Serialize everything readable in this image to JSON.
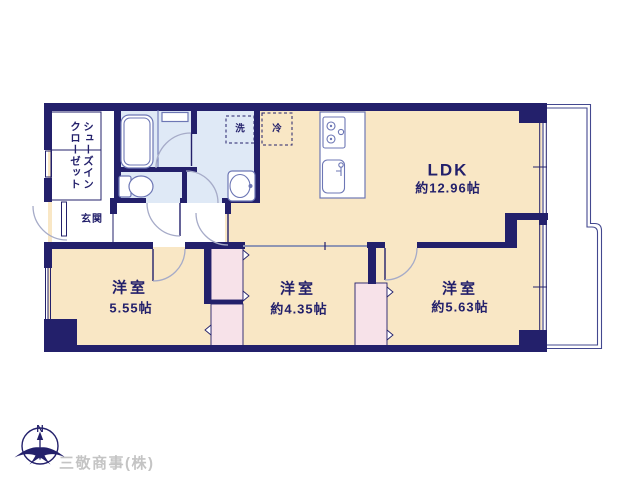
{
  "floor_plan": {
    "rooms": {
      "ldk": {
        "label": "LDK",
        "size": "約12.96帖"
      },
      "bedroom_left": {
        "label": "洋室",
        "size": "5.55帖"
      },
      "bedroom_middle": {
        "label": "洋室",
        "size": "約4.35帖"
      },
      "bedroom_right": {
        "label": "洋室",
        "size": "約5.63帖"
      },
      "entrance": {
        "label": "玄関"
      },
      "shoe_closet": {
        "label_line1": "シューズイン",
        "label_line2": "クローゼット"
      }
    },
    "fixtures": {
      "washer": "洗",
      "refrigerator": "冷"
    },
    "compass": {
      "north": "N"
    },
    "footer": {
      "company": "三敬商事(株)"
    },
    "colors": {
      "wall": "#23206b",
      "room_tan": "#f9e7c5",
      "wet_blue": "#dfe9f6",
      "closet_pink": "#f7e2e9",
      "fixture_line": "#6d77b5",
      "door_arc": "#a6abc8",
      "text_navy": "#23206b",
      "company_gray": "#c4c4c4"
    }
  }
}
